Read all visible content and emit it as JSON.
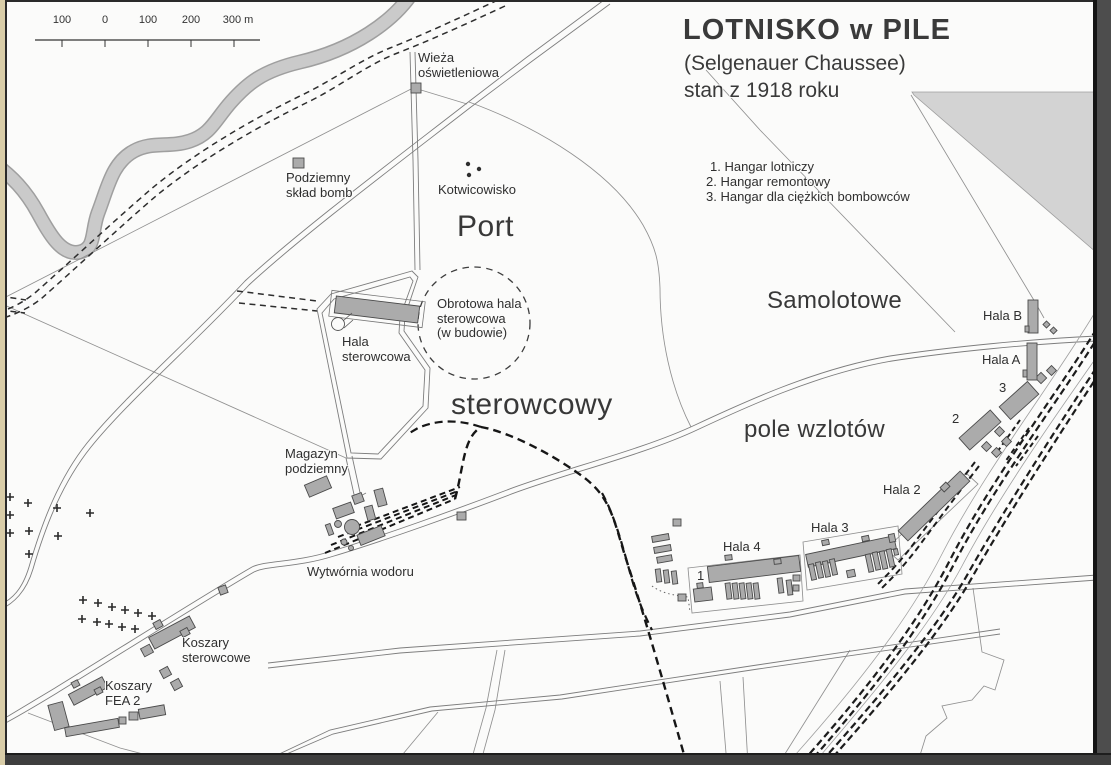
{
  "colors": {
    "paper": "#fbfbfa",
    "ink": "#2f2f2f",
    "building_fill": "#ababab",
    "building_stroke": "#4a4a4a",
    "river": "#cacaca",
    "forest": "#d3d3d3",
    "road": "#7d7d7d",
    "rail": "#1c1c1c",
    "border_tan": "#d9cda8"
  },
  "title": {
    "line1": "LOTNISKO w PILE",
    "line2": "(Selgenauer Chaussee)",
    "line3": "stan z 1918 roku"
  },
  "legend": {
    "items": [
      "1. Hangar lotniczy",
      "2. Hangar remontowy",
      "3. Hangar dla ciężkich bombowców"
    ]
  },
  "scale_bar": {
    "labels": [
      "100",
      "0",
      "100",
      "200",
      "300 m"
    ]
  },
  "labels": {
    "wieza": "Wieża\noświetleniowa",
    "podziemny_sklad": "Podziemny\nskład bomb",
    "kotwicowisko": "Kotwicowisko",
    "port": "Port",
    "sterowcowy": "sterowcowy",
    "obrotowa": "Obrotowa hala\nsterowcowa\n(w budowie)",
    "hala_sterowcowa": "Hala\nsterowcowa",
    "magazyn": "Magazyn\npodziemny",
    "wytwornia": "Wytwórnia wodoru",
    "samolotowe": "Samolotowe",
    "pole_wzlotow": "pole wzlotów",
    "hala_2": "Hala 2",
    "hala_3": "Hala 3",
    "hala_4": "Hala 4",
    "hala_a": "Hala A",
    "hala_b": "Hala B",
    "num_1": "1",
    "num_2": "2",
    "num_3": "3",
    "koszary_sterowcowe": "Koszary\nsterowcowe",
    "koszary_fea": "Koszary\nFEA 2"
  }
}
